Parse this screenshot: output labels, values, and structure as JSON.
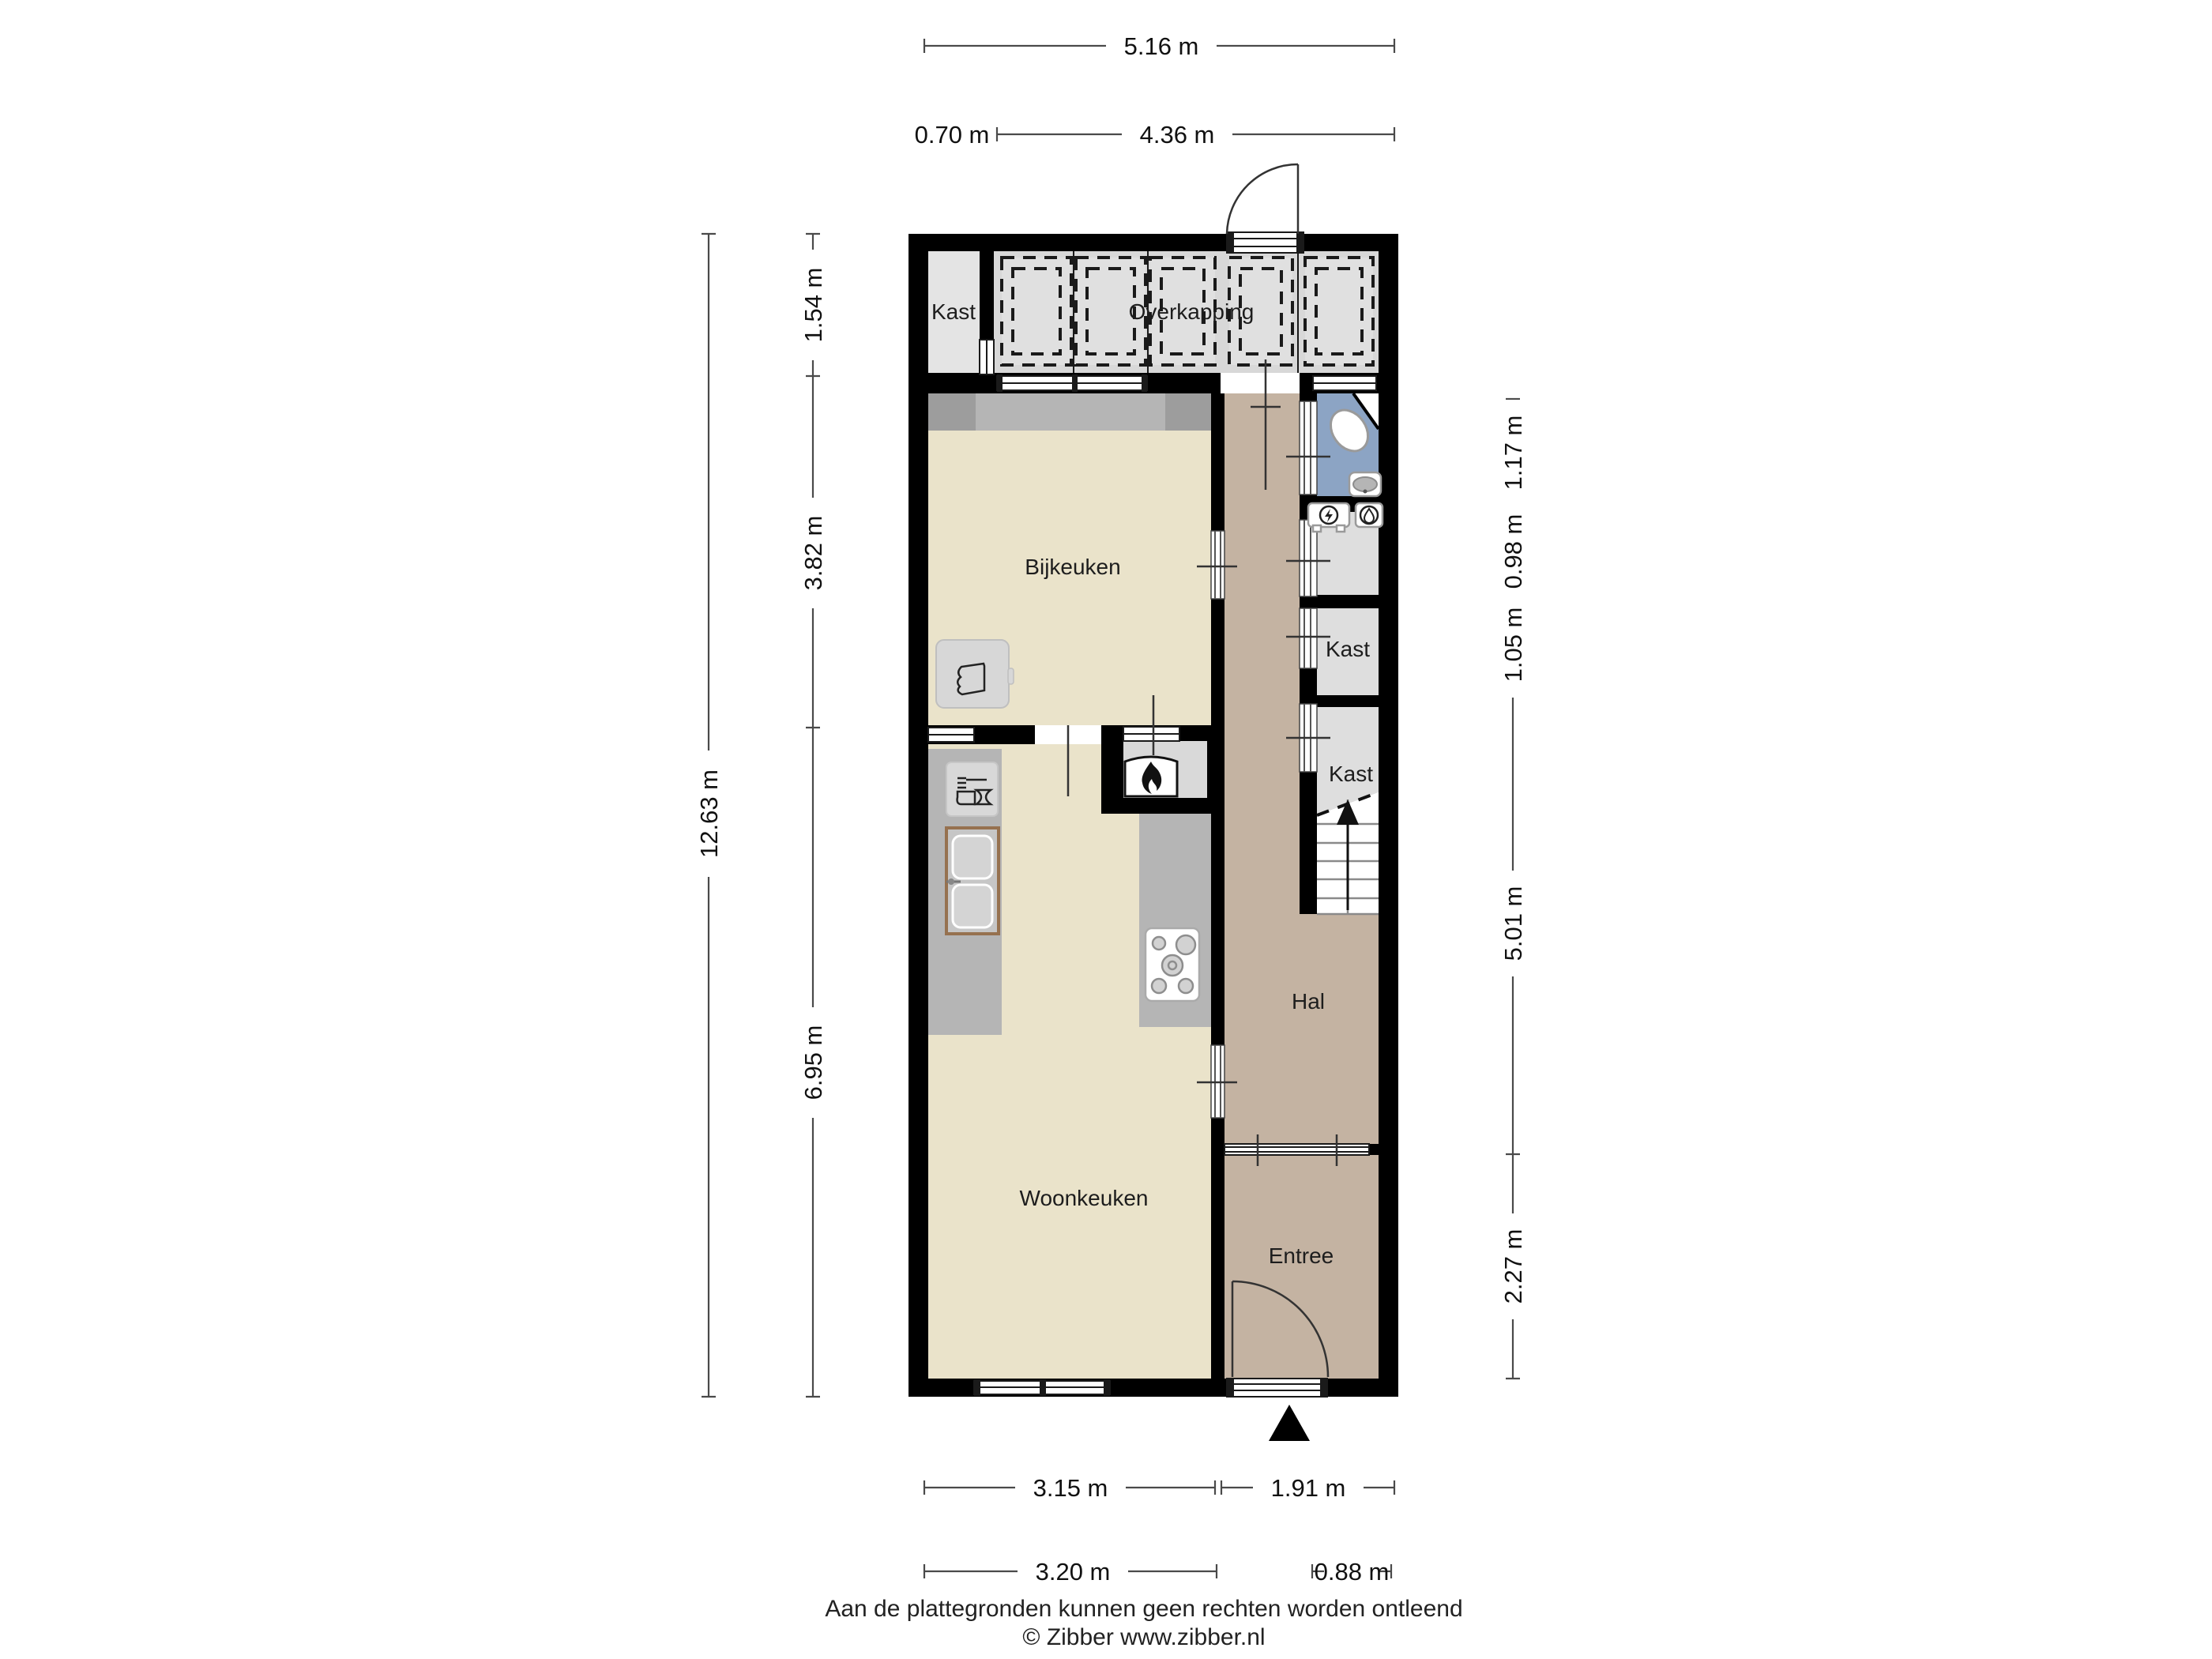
{
  "rooms": {
    "kast_top": "Kast",
    "overkapping": "Overkapping",
    "bijkeuken": "Bijkeuken",
    "kast_1": "Kast",
    "kast_2": "Kast",
    "hal": "Hal",
    "woonkeuken": "Woonkeuken",
    "entree": "Entree"
  },
  "dims": {
    "top_total": "5.16 m",
    "top_kast": "0.70 m",
    "top_overkapping": "4.36 m",
    "left_total": "12.63 m",
    "left_overkapping": "1.54 m",
    "left_bijkeuken": "3.82 m",
    "left_woonkeuken": "6.95 m",
    "right_toilet": "1.17 m",
    "right_meterkast": "0.98 m",
    "right_kast": "1.05 m",
    "right_hal": "5.01 m",
    "right_entree": "2.27 m",
    "bottom_woonkeuken": "3.15 m",
    "bottom_hal": "1.91 m",
    "bottom_woonkeuken_2": "3.20 m",
    "bottom_entree": "0.88 m"
  },
  "footer": {
    "disclaimer": "Aan de plattegronden kunnen geen rechten worden ontleend",
    "copyright": "© Zibber www.zibber.nl"
  },
  "colors": {
    "wall": "#000000",
    "room_cream": "#EAE3CA",
    "room_taupe": "#C4B3A2",
    "room_blue": "#8CA4C4",
    "room_gray": "#DEDEDE",
    "room_gray_light": "#E4E4E4",
    "overkapping_bg": "#D8D8D8",
    "overkapping_panel": "#E0E0E0",
    "counter": "#B5B5B5",
    "counter_dark": "#9D9D9D",
    "niche": "#D9D9D9"
  }
}
